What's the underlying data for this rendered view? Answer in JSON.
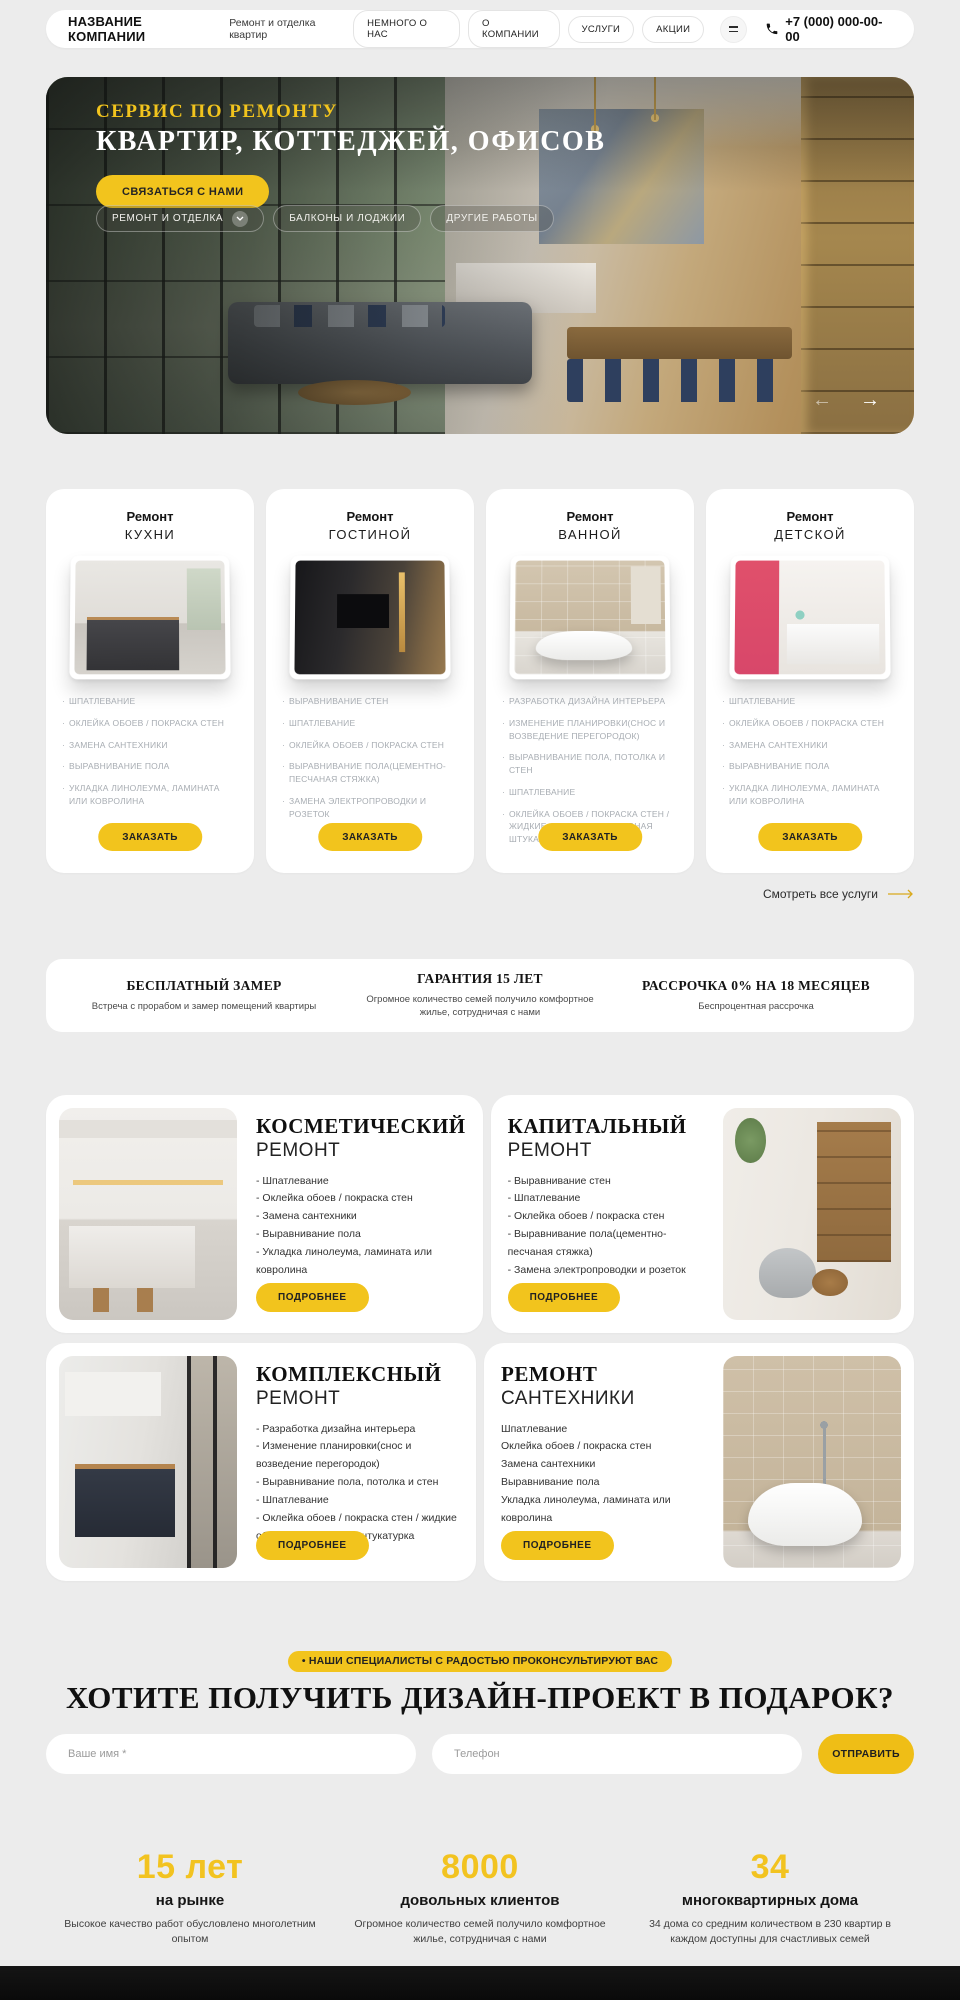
{
  "colors": {
    "accent": "#F2C41D",
    "page_bg": "#ECECEC",
    "card_bg": "#FFFFFF",
    "footer_bg": "#0A0A0A"
  },
  "header": {
    "company_name": "НАЗВАНИЕ КОМПАНИИ",
    "tagline": "Ремонт и отделка квартир",
    "nav": [
      "НЕМНОГО О НАС",
      "О КОМПАНИИ",
      "УСЛУГИ",
      "АКЦИИ"
    ],
    "phone": "+7 (000) 000-00-00"
  },
  "hero": {
    "kicker": "СЕРВИС ПО РЕМОНТУ",
    "title": "КВАРТИР, КОТТЕДЖЕЙ, ОФИСОВ",
    "cta": "СВЯЗАТЬСЯ С НАМИ",
    "tabs": [
      "РЕМОНТ И ОТДЕЛКА",
      "БАЛКОНЫ И ЛОДЖИИ",
      "ДРУГИЕ РАБОТЫ"
    ],
    "prev_arrow": "←",
    "next_arrow": "→"
  },
  "services": {
    "cards": [
      {
        "title_top": "Ремонт",
        "title_bottom": "КУХНИ",
        "items": [
          "ШПАТЛЕВАНИЕ",
          "ОКЛЕЙКА ОБОЕВ / ПОКРАСКА СТЕН",
          "ЗАМЕНА САНТЕХНИКИ",
          "ВЫРАВНИВАНИЕ ПОЛА",
          "УКЛАДКА ЛИНОЛЕУМА, ЛАМИНАТА ИЛИ КОВРОЛИНА"
        ],
        "button": "ЗАКАЗАТЬ"
      },
      {
        "title_top": "Ремонт",
        "title_bottom": "ГОСТИНОЙ",
        "items": [
          "ВЫРАВНИВАНИЕ СТЕН",
          "ШПАТЛЕВАНИЕ",
          "ОКЛЕЙКА ОБОЕВ / ПОКРАСКА СТЕН",
          "ВЫРАВНИВАНИЕ ПОЛА(ЦЕМЕНТНО-ПЕСЧАНАЯ СТЯЖКА)",
          "ЗАМЕНА ЭЛЕКТРОПРОВОДКИ И РОЗЕТОК"
        ],
        "button": "ЗАКАЗАТЬ"
      },
      {
        "title_top": "Ремонт",
        "title_bottom": "ВАННОЙ",
        "items": [
          "РАЗРАБОТКА ДИЗАЙНА ИНТЕРЬЕРА",
          "ИЗМЕНЕНИЕ ПЛАНИРОВКИ(СНОС И ВОЗВЕДЕНИЕ ПЕРЕГОРОДОК)",
          "ВЫРАВНИВАНИЕ ПОЛА, ПОТОЛКА И СТЕН",
          "ШПАТЛЕВАНИЕ",
          "ОКЛЕЙКА ОБОЕВ / ПОКРАСКА СТЕН / ЖИДКИЕ ОБОИ / ДЕКОРАТИВНАЯ ШТУКАТУРКА"
        ],
        "button": "ЗАКАЗАТЬ"
      },
      {
        "title_top": "Ремонт",
        "title_bottom": "ДЕТСКОЙ",
        "items": [
          "ШПАТЛЕВАНИЕ",
          "ОКЛЕЙКА ОБОЕВ / ПОКРАСКА СТЕН",
          "ЗАМЕНА САНТЕХНИКИ",
          "ВЫРАВНИВАНИЕ ПОЛА",
          "УКЛАДКА ЛИНОЛЕУМА, ЛАМИНАТА ИЛИ КОВРОЛИНА"
        ],
        "button": "ЗАКАЗАТЬ"
      }
    ],
    "view_all": "Смотреть все услуги"
  },
  "benefits": [
    {
      "title": "БЕСПЛАТНЫЙ ЗАМЕР",
      "text": "Встреча с прорабом и замер помещений квартиры"
    },
    {
      "title": "ГАРАНТИЯ 15 ЛЕТ",
      "text": "Огромное количество семей получило комфортное жилье, сотрудничая с нами"
    },
    {
      "title": "РАССРОЧКА 0% НА 18 МЕСЯЦЕВ",
      "text": "Беспроцентная рассрочка"
    }
  ],
  "repair_types": [
    {
      "title_top": "КОСМЕТИЧЕСКИЙ",
      "title_bottom": "РЕМОНТ",
      "items": [
        "- Шпатлевание",
        "- Оклейка обоев / покраска стен",
        "- Замена сантехники",
        "- Выравнивание пола",
        "- Укладка линолеума, ламината или ковролина"
      ],
      "button": "ПОДРОБНЕЕ"
    },
    {
      "title_top": "КАПИТАЛЬНЫЙ",
      "title_bottom": "РЕМОНТ",
      "items": [
        "- Выравнивание стен",
        "- Шпатлевание",
        "- Оклейка обоев / покраска стен",
        "- Выравнивание пола(цементно-песчаная стяжка)",
        "- Замена электропроводки и розеток"
      ],
      "button": "ПОДРОБНЕЕ"
    },
    {
      "title_top": "КОМПЛЕКСНЫЙ",
      "title_bottom": "РЕМОНТ",
      "items": [
        "- Разработка дизайна интерьера",
        "- Изменение планировки(снос и возведение перегородок)",
        "- Выравнивание пола, потолка и стен",
        "- Шпатлевание",
        "- Оклейка обоев / покраска стен / жидкие обои / декоративная штукатурка"
      ],
      "button": "ПОДРОБНЕЕ"
    },
    {
      "title_top": "РЕМОНТ",
      "title_bottom": "САНТЕХНИКИ",
      "items": [
        "Шпатлевание",
        "Оклейка обоев / покраска стен",
        "Замена сантехники",
        "Выравнивание пола",
        "Укладка линолеума, ламината или ковролина"
      ],
      "button": "ПОДРОБНЕЕ"
    }
  ],
  "cta": {
    "badge": "• НАШИ СПЕЦИАЛИСТЫ С РАДОСТЬЮ ПРОКОНСУЛЬТИРУЮТ ВАС",
    "title": "ХОТИТЕ ПОЛУЧИТЬ ДИЗАЙН-ПРОЕКТ В ПОДАРОК?",
    "name_placeholder": "Ваше имя *",
    "phone_placeholder": "Телефон",
    "submit": "ОТПРАВИТЬ"
  },
  "stats": [
    {
      "value": "15 лет",
      "label": "на рынке",
      "text": "Высокое качество работ обусловлено многолетним опытом"
    },
    {
      "value": "8000",
      "label": "довольных клиентов",
      "text": "Огромное количество семей получило комфортное жилье, сотрудничая с нами"
    },
    {
      "value": "34",
      "label": "многоквартирных дома",
      "text": "34 дома со средним количеством в 230 квартир в каждом доступны для счастливых семей"
    }
  ]
}
